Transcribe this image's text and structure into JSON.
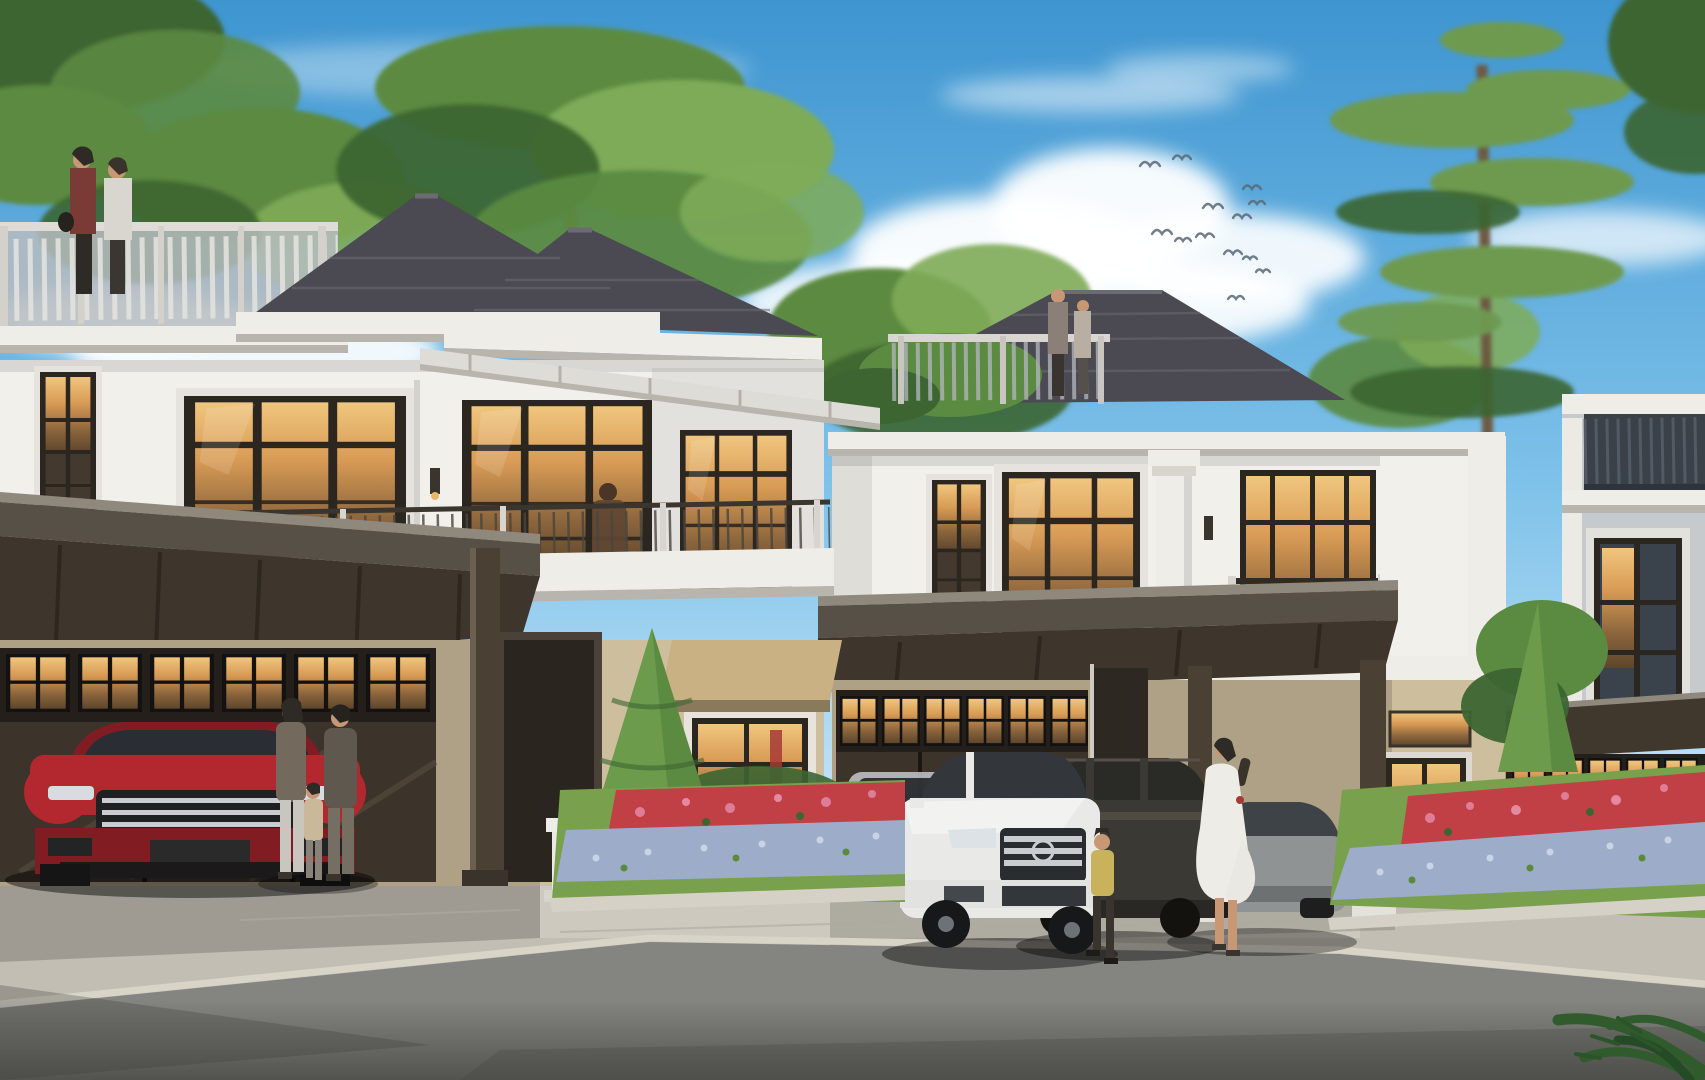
{
  "meta": {
    "type": "architectural-exterior-rendering",
    "subject": "Row of luxury modern-classic two-storey townhouses with rooftop terraces, carports, warm-lit windows, landscaped flower beds, parked SUVs and residents, under a blue sky with a bird flock and tall pine tree",
    "time_of_day": "daytime"
  },
  "scene": {
    "objects": [
      "sky",
      "clouds",
      "bird-flock",
      "background-trees",
      "pine-tree",
      "townhouse-1",
      "townhouse-2",
      "townhouse-3",
      "rooftop-terrace-people",
      "balcony-person",
      "red-suv",
      "white-suv",
      "dark-suv",
      "gray-sedan",
      "silver-car-in-garage",
      "family-group",
      "woman-in-white-dress",
      "child",
      "topiary-trees",
      "flower-beds",
      "lawn",
      "driveway",
      "street",
      "palm-fronds"
    ]
  },
  "palette": {
    "sky_top": "#3E95D0",
    "sky_mid": "#7FC2EA",
    "sky_low": "#CDE9F8",
    "cloud": "#FFFFFF",
    "bird": "#5A6878",
    "tree_dark": "#3C6532",
    "tree_mid": "#5B8A41",
    "tree_light": "#7EAB58",
    "pine": "#6E9A50",
    "trunk": "#6E5A43",
    "roof": "#4B4A52",
    "roof_ridge": "#6C6B74",
    "fascia_white": "#EFEDE8",
    "fascia_shadow": "#B8B4AE",
    "wall_white": "#F2F0EB",
    "wall_shade": "#DBD7D1",
    "wall_gray": "#C7CACC",
    "wall_tan": "#CDBE9E",
    "frame_dark": "#2B2620",
    "glass_dark": "#43392E",
    "garage_dark": "#241F1A",
    "garage_panel": "#3C342A",
    "carport_dark": "#40382D",
    "carport_fascia": "#575046",
    "carport_edge": "#8F887D",
    "post": "#4A4034",
    "red_car": "#B2282E",
    "red_car_dark": "#811D22",
    "white_car": "#E9E9E7",
    "dark_car": "#3B3933",
    "gray_car": "#8F9394",
    "chrome": "#C9CDD1",
    "car_glass": "#33373C",
    "drive": "#C3BEB4",
    "drive_light": "#D2CDC2",
    "road": "#848480",
    "road_dark": "#4F4F4C",
    "lawn": "#79A04D",
    "lawn_dark": "#5C8A3B",
    "flower_red": "#C14045",
    "flower_pink": "#DD7D98",
    "flower_lavender": "#9DACC8",
    "flower_light": "#C9D3E6",
    "awning": "#C9B184",
    "sign_glow": "#D9BE82",
    "palm": "#2F5B2D",
    "skin": "#C79873",
    "person_dark": "#3A342E",
    "person_white": "#EDECE6",
    "person_yellow": "#C8B35C",
    "person_olive": "#73695C",
    "person_red": "#7A3B36"
  }
}
